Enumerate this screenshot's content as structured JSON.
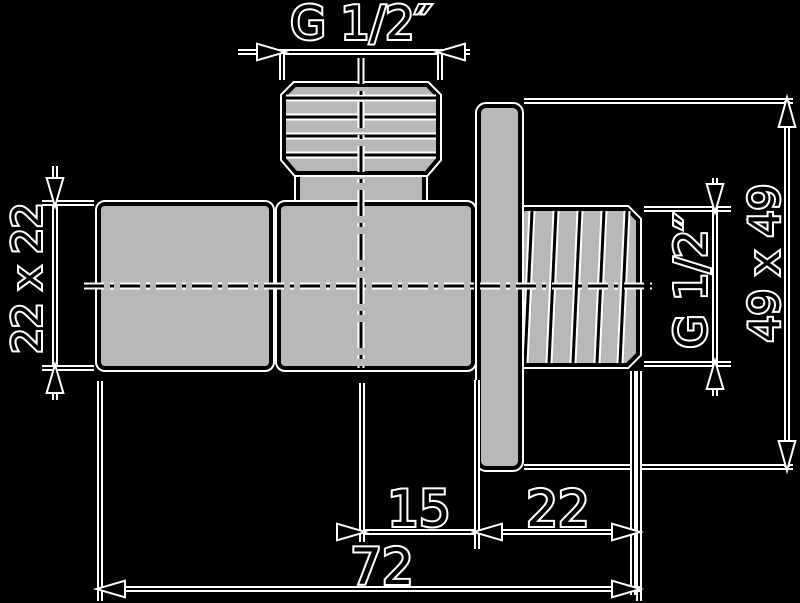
{
  "drawing": {
    "type": "technical-dimension-drawing",
    "subject": "angle-valve-with-wall-plate-side-view",
    "background": "#000000",
    "colors": {
      "part_fill": "#b8b8b8",
      "line": "#000000",
      "halo": "#ffffff"
    },
    "labels": {
      "top_thread": "G 1/2″",
      "handle_section": "22 x 22",
      "outlet_thread": "G 1/2″",
      "plate_section": "49 x 49"
    },
    "dims": {
      "center_to_wall": "15",
      "wall_to_pipe_end": "22",
      "total_length": "72"
    }
  }
}
